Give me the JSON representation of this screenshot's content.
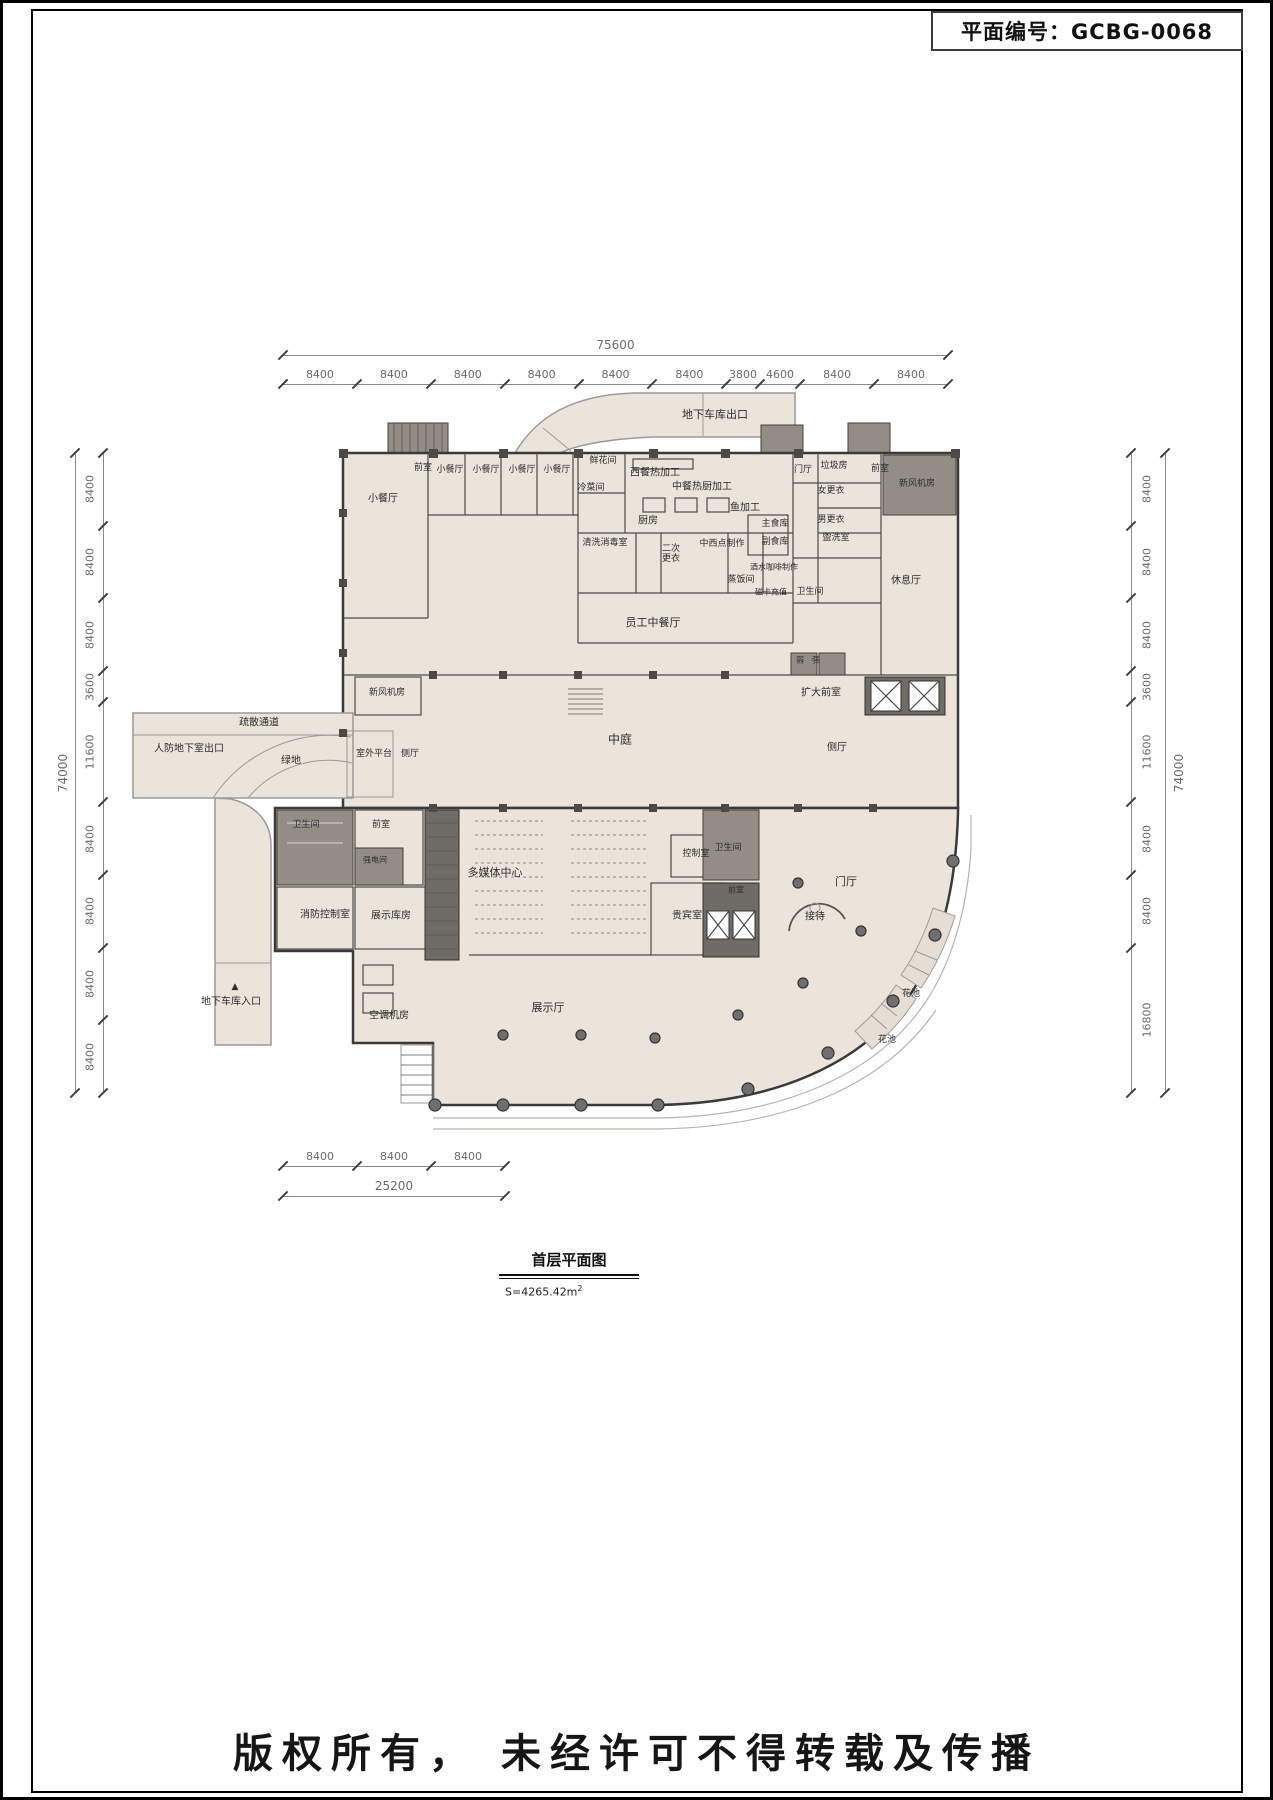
{
  "page": {
    "plan_number_label": "平面编号：GCBG-0068",
    "copyright": "版权所有， 未经许可不得转载及传播"
  },
  "drawing_title": {
    "title": "首层平面图",
    "area_label": "S=4265.42m",
    "area_sup": "2"
  },
  "dimensions": {
    "top": {
      "total": "75600",
      "segments": [
        8400,
        8400,
        8400,
        8400,
        8400,
        8400,
        3800,
        4600,
        8400,
        8400
      ]
    },
    "left": {
      "total": "74000",
      "segments": [
        8400,
        8400,
        8400,
        3600,
        11600,
        8400,
        8400,
        8400,
        8400
      ]
    },
    "right": {
      "total": "74000",
      "segments": [
        8400,
        8400,
        8400,
        3600,
        11600,
        8400,
        8400,
        16800
      ]
    },
    "bottom": {
      "total": "25200",
      "segments": [
        8400,
        8400,
        8400
      ]
    }
  },
  "rooms": [
    {
      "label": "地下车库出口",
      "x": 712,
      "y": 412,
      "size": 11
    },
    {
      "label": "前室",
      "x": 420,
      "y": 466,
      "size": 9
    },
    {
      "label": "小餐厅",
      "x": 447,
      "y": 468,
      "size": 9
    },
    {
      "label": "小餐厅",
      "x": 483,
      "y": 468,
      "size": 9
    },
    {
      "label": "小餐厅",
      "x": 519,
      "y": 468,
      "size": 9
    },
    {
      "label": "小餐厅",
      "x": 554,
      "y": 468,
      "size": 9
    },
    {
      "label": "小餐厅",
      "x": 380,
      "y": 496,
      "size": 10
    },
    {
      "label": "鲜花间",
      "x": 600,
      "y": 459,
      "size": 9
    },
    {
      "label": "冷菜间",
      "x": 588,
      "y": 486,
      "size": 9
    },
    {
      "label": "西餐热加工",
      "x": 652,
      "y": 470,
      "size": 10
    },
    {
      "label": "中餐热厨加工",
      "x": 699,
      "y": 484,
      "size": 10
    },
    {
      "label": "厨房",
      "x": 645,
      "y": 518,
      "size": 10
    },
    {
      "label": "鱼加工",
      "x": 742,
      "y": 505,
      "size": 10
    },
    {
      "label": "清洗消毒室",
      "x": 602,
      "y": 541,
      "size": 9
    },
    {
      "label": "二次\n更衣",
      "x": 668,
      "y": 552,
      "size": 9
    },
    {
      "label": "中西点制作",
      "x": 719,
      "y": 542,
      "size": 9
    },
    {
      "label": "主食库",
      "x": 772,
      "y": 522,
      "size": 9
    },
    {
      "label": "副食库",
      "x": 772,
      "y": 540,
      "size": 9
    },
    {
      "label": "蒸饭间",
      "x": 738,
      "y": 578,
      "size": 9
    },
    {
      "label": "酒水咖啡制作",
      "x": 771,
      "y": 565,
      "size": 8
    },
    {
      "label": "磁卡充值",
      "x": 768,
      "y": 590,
      "size": 8
    },
    {
      "label": "卫生间",
      "x": 807,
      "y": 590,
      "size": 9
    },
    {
      "label": "门厅",
      "x": 800,
      "y": 468,
      "size": 9
    },
    {
      "label": "垃圾房",
      "x": 831,
      "y": 464,
      "size": 9
    },
    {
      "label": "女更衣",
      "x": 828,
      "y": 489,
      "size": 9
    },
    {
      "label": "男更衣",
      "x": 828,
      "y": 518,
      "size": 9
    },
    {
      "label": "盥洗室",
      "x": 833,
      "y": 536,
      "size": 9
    },
    {
      "label": "前室",
      "x": 877,
      "y": 467,
      "size": 9
    },
    {
      "label": "新风机房",
      "x": 914,
      "y": 482,
      "size": 9
    },
    {
      "label": "休息厅",
      "x": 903,
      "y": 578,
      "size": 10
    },
    {
      "label": "员工中餐厅",
      "x": 650,
      "y": 620,
      "size": 11
    },
    {
      "label": "弱",
      "x": 797,
      "y": 658,
      "size": 8
    },
    {
      "label": "强",
      "x": 813,
      "y": 658,
      "size": 8
    },
    {
      "label": "新风机房",
      "x": 384,
      "y": 691,
      "size": 9
    },
    {
      "label": "扩大前室",
      "x": 818,
      "y": 690,
      "size": 10
    },
    {
      "label": "疏散通道",
      "x": 256,
      "y": 720,
      "size": 10
    },
    {
      "label": "人防地下室出口",
      "x": 186,
      "y": 746,
      "size": 10
    },
    {
      "label": "绿地",
      "x": 288,
      "y": 758,
      "size": 10
    },
    {
      "label": "室外平台",
      "x": 371,
      "y": 752,
      "size": 9
    },
    {
      "label": "侧厅",
      "x": 407,
      "y": 752,
      "size": 9
    },
    {
      "label": "中庭",
      "x": 617,
      "y": 737,
      "size": 12
    },
    {
      "label": "侧厅",
      "x": 834,
      "y": 745,
      "size": 10
    },
    {
      "label": "卫生间",
      "x": 303,
      "y": 823,
      "size": 9
    },
    {
      "label": "前室",
      "x": 378,
      "y": 823,
      "size": 9
    },
    {
      "label": "强电间",
      "x": 372,
      "y": 858,
      "size": 8
    },
    {
      "label": "多媒体中心",
      "x": 492,
      "y": 870,
      "size": 11
    },
    {
      "label": "控制室",
      "x": 693,
      "y": 852,
      "size": 9
    },
    {
      "label": "卫生间",
      "x": 725,
      "y": 846,
      "size": 9
    },
    {
      "label": "前室",
      "x": 733,
      "y": 888,
      "size": 8
    },
    {
      "label": "消防控制室",
      "x": 322,
      "y": 912,
      "size": 10
    },
    {
      "label": "展示库房",
      "x": 388,
      "y": 913,
      "size": 10
    },
    {
      "label": "贵宾室",
      "x": 684,
      "y": 913,
      "size": 10
    },
    {
      "label": "门厅",
      "x": 843,
      "y": 879,
      "size": 11
    },
    {
      "label": "接待",
      "x": 812,
      "y": 914,
      "size": 10
    },
    {
      "label": "空调机房",
      "x": 386,
      "y": 1013,
      "size": 10
    },
    {
      "label": "展示厅",
      "x": 545,
      "y": 1005,
      "size": 11
    },
    {
      "label": "▲",
      "x": 232,
      "y": 985,
      "size": 9
    },
    {
      "label": "地下车库入口",
      "x": 228,
      "y": 999,
      "size": 10
    },
    {
      "label": "花池",
      "x": 908,
      "y": 992,
      "size": 9
    },
    {
      "label": "花池",
      "x": 884,
      "y": 1038,
      "size": 9
    }
  ],
  "colors": {
    "paper": "#ffffff",
    "floor_fill": "#ece3da",
    "wall": "#3a3a3a",
    "service_block": "#938d86",
    "core_block": "#6f6b66",
    "dimension": "#6a6a6a"
  }
}
